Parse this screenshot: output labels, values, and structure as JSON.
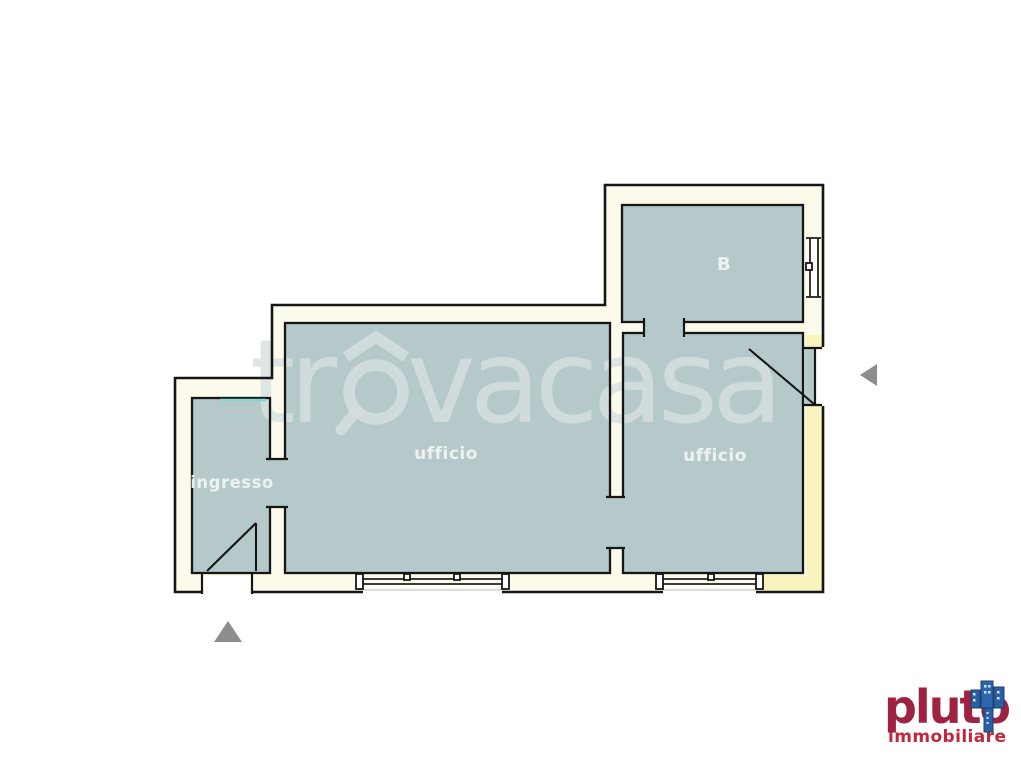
{
  "floorplan": {
    "rooms": [
      {
        "id": "ingresso",
        "label": "ingresso"
      },
      {
        "id": "ufficio-left",
        "label": "ufficio"
      },
      {
        "id": "ufficio-right",
        "label": "ufficio"
      },
      {
        "id": "bathroom",
        "label": "B"
      }
    ],
    "colors": {
      "room_fill": "#b6c9ca",
      "wall_fill": "#fcfaea",
      "wall_accent": "#f9f3bd",
      "outline": "#161616",
      "label_text": "#f0f5f4",
      "marker_gray": "#8d8d8d",
      "accent_cyan": "#84d6d2"
    }
  },
  "watermark": {
    "full_text": "trovacasa",
    "text_prefix": "tr",
    "text_suffix": "vacasa",
    "color": "#d7e0e0"
  },
  "logo": {
    "name": "pluto",
    "tagline": "immobiliare",
    "name_color": "#9f2240",
    "tagline_color": "#c2273b",
    "building_color": "#2b5fa3"
  }
}
